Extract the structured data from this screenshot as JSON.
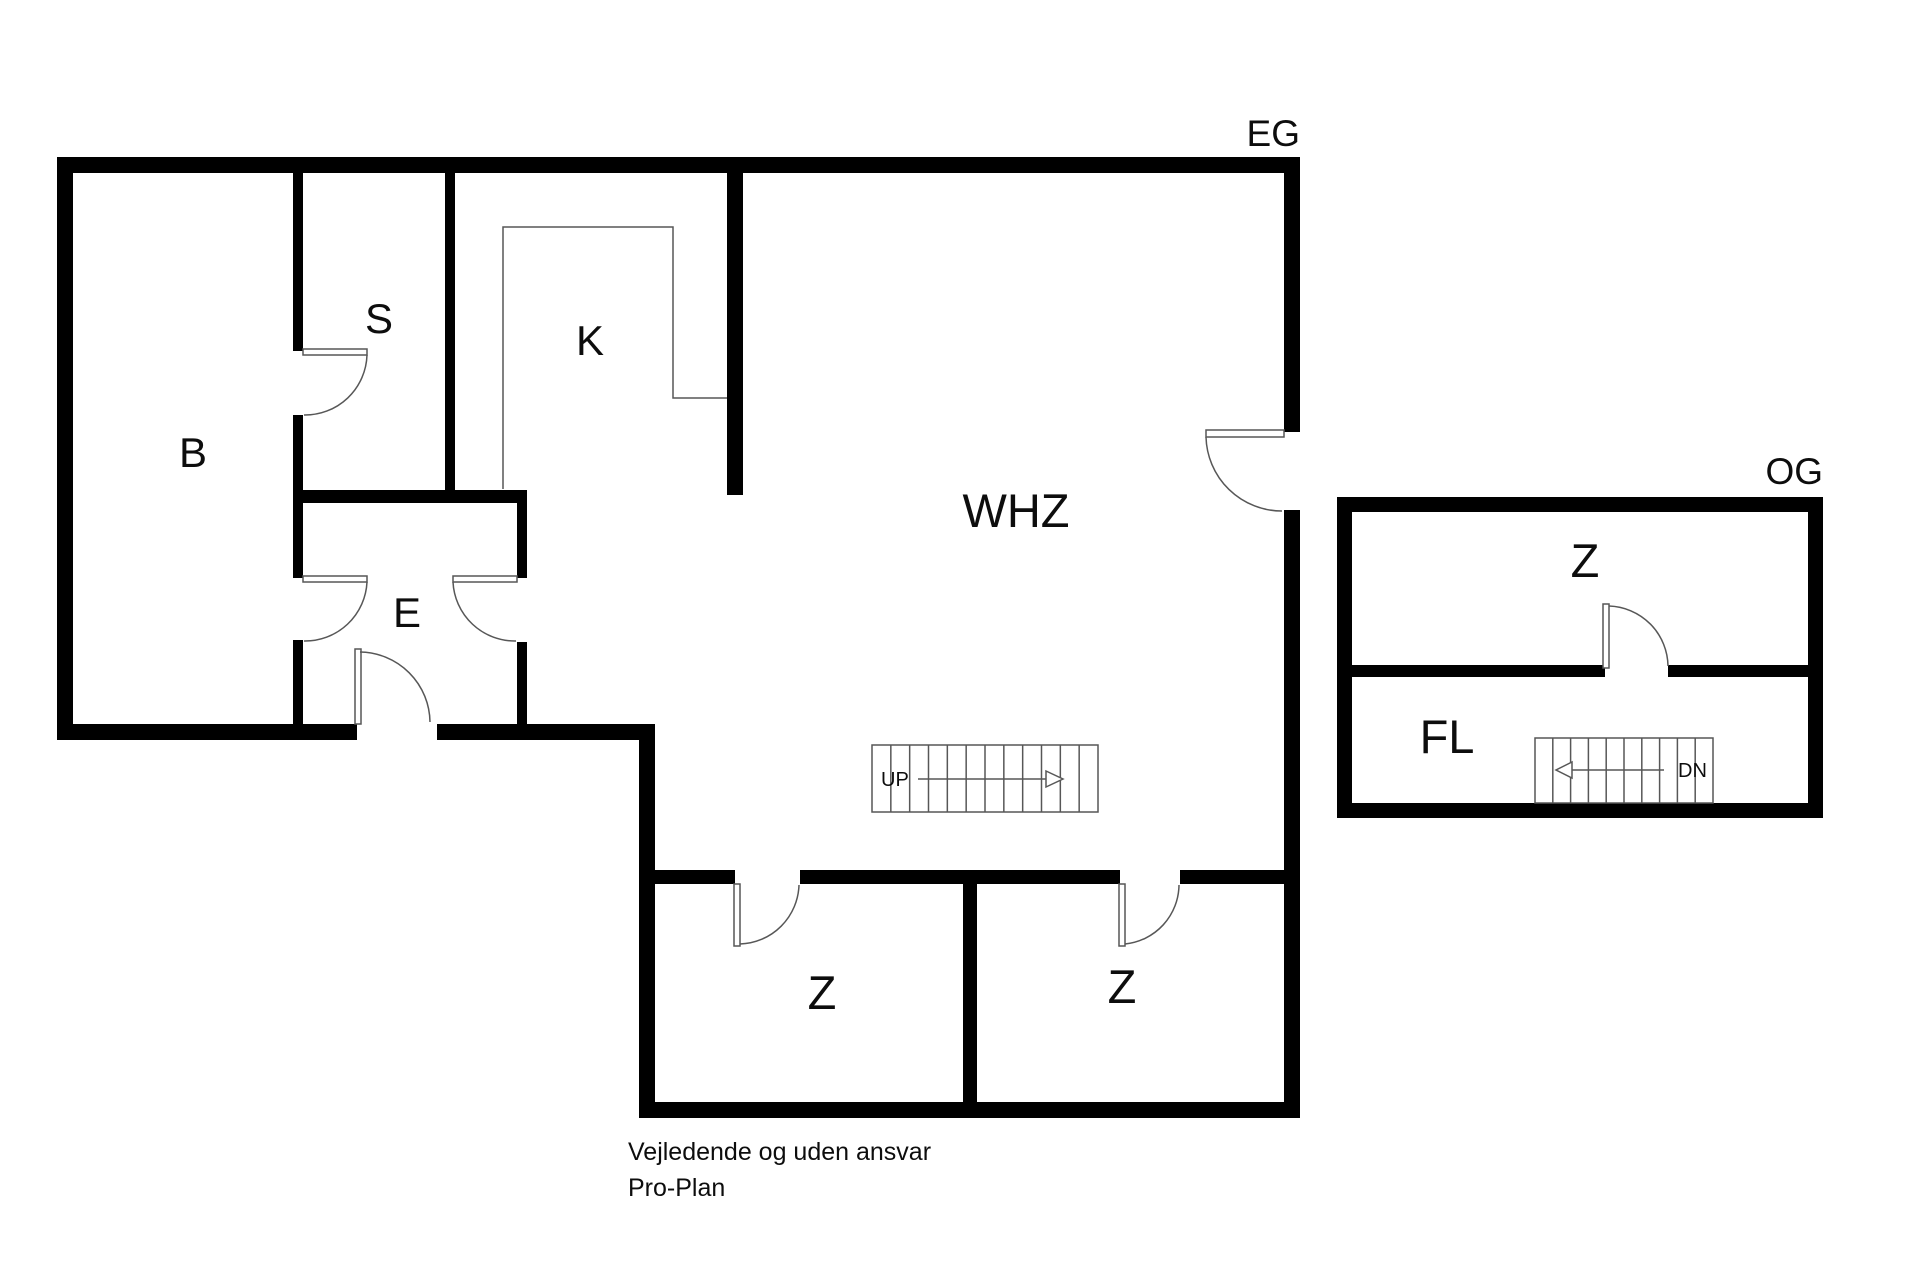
{
  "eg": {
    "title": "EG",
    "rooms": {
      "b": "B",
      "s": "S",
      "k": "K",
      "e": "E",
      "whz": "WHZ",
      "z_left": "Z",
      "z_right": "Z"
    },
    "stairs": {
      "label": "UP",
      "cells": 12
    }
  },
  "og": {
    "title": "OG",
    "rooms": {
      "z": "Z",
      "fl": "FL"
    },
    "stairs": {
      "label": "DN",
      "cells": 10
    }
  },
  "footer": {
    "line1": "Vejledende og uden ansvar",
    "line2": "Pro-Plan"
  },
  "colors": {
    "wall": "#000000",
    "line": "#575757",
    "text": "#0d0d0d",
    "background": "#ffffff"
  }
}
